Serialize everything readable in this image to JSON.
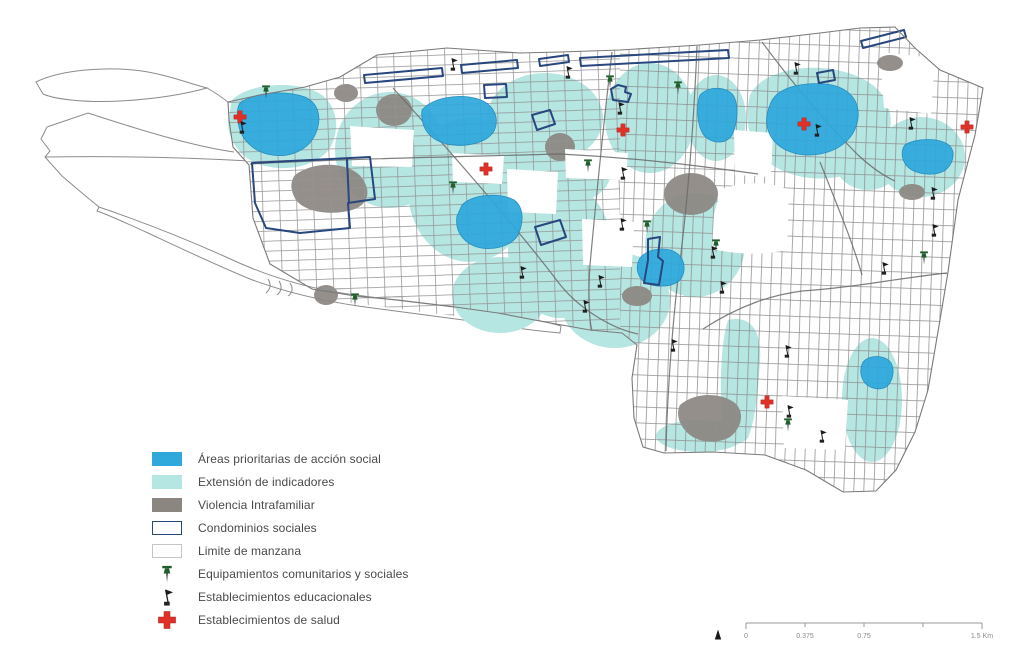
{
  "legend": {
    "items": [
      {
        "key": "priority-areas",
        "swatch": "fill-blue",
        "label": "Áreas prioritarias de acción social"
      },
      {
        "key": "indicator-extent",
        "swatch": "fill-cyan",
        "label": "Extensión de indicadores"
      },
      {
        "key": "domestic-violence",
        "swatch": "fill-gray",
        "label": "Violencia Intrafamiliar"
      },
      {
        "key": "social-condominiums",
        "swatch": "outline-navy",
        "label": "Condominios sociales"
      },
      {
        "key": "block-limit",
        "swatch": "outline-light",
        "label": "Limite de manzana"
      },
      {
        "key": "community-facilities",
        "swatch": "pin",
        "label": "Equipamientos comunitarios y sociales"
      },
      {
        "key": "education-facilities",
        "swatch": "flag",
        "label": "Establecimientos educacionales"
      },
      {
        "key": "health-facilities",
        "swatch": "cross",
        "label": "Establecimientos de salud"
      }
    ]
  },
  "scalebar": {
    "tick_labels": [
      "0",
      "0.375",
      "0.75",
      "",
      "1.5 Km"
    ]
  },
  "colors": {
    "priority": "#2FA8DC",
    "priority_edge": "#1E88BE",
    "extent": "#B5E6E2",
    "violence": "#8B8680",
    "condo": "#27477E",
    "pin": "#1E5F2C",
    "flag": "#1A1A1A",
    "cross": "#E03128"
  },
  "markers": {
    "health": [
      [
        240,
        117
      ],
      [
        486,
        169
      ],
      [
        623,
        130
      ],
      [
        804,
        124
      ],
      [
        967,
        127
      ],
      [
        767,
        402
      ]
    ],
    "community": [
      [
        266,
        92
      ],
      [
        453,
        188
      ],
      [
        588,
        166
      ],
      [
        610,
        82
      ],
      [
        678,
        88
      ],
      [
        647,
        227
      ],
      [
        716,
        246
      ],
      [
        355,
        300
      ],
      [
        788,
        425
      ],
      [
        924,
        258
      ]
    ],
    "education": [
      [
        242,
        127
      ],
      [
        453,
        64
      ],
      [
        568,
        72
      ],
      [
        620,
        108
      ],
      [
        623,
        173
      ],
      [
        622,
        224
      ],
      [
        522,
        272
      ],
      [
        600,
        281
      ],
      [
        585,
        306
      ],
      [
        673,
        345
      ],
      [
        713,
        252
      ],
      [
        722,
        287
      ],
      [
        787,
        351
      ],
      [
        789,
        411
      ],
      [
        822,
        436
      ],
      [
        933,
        193
      ],
      [
        934,
        230
      ],
      [
        884,
        268
      ],
      [
        796,
        68
      ],
      [
        817,
        130
      ],
      [
        911,
        123
      ]
    ]
  }
}
